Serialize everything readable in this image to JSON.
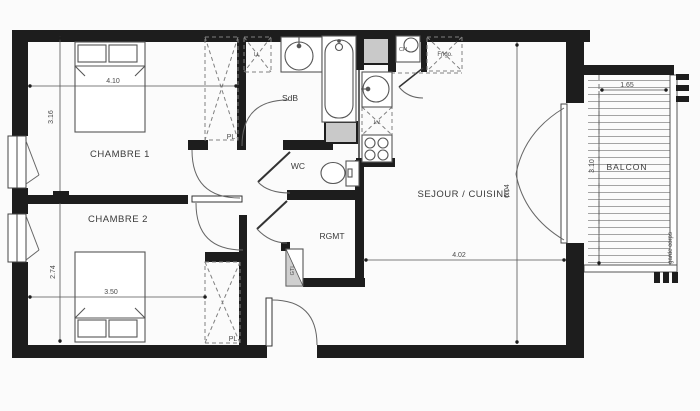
{
  "plan": {
    "title_hint": "apartment floor plan",
    "rooms": {
      "chambre1": "CHAMBRE 1",
      "chambre2": "CHAMBRE 2",
      "sdb": "SdB",
      "wc": "WC",
      "rgmt": "RGMT",
      "sejour": "SEJOUR / CUISINE",
      "balcon": "BALCON"
    },
    "closets": {
      "pl1": "PL",
      "pl2": "PL",
      "gtl": "GTL"
    },
    "appliances": {
      "ll": "LL",
      "lv": "LV",
      "ch": "CH",
      "frigo": "Frigo."
    },
    "dimensions": {
      "chambre1_width": "4.10",
      "chambre1_depth": "3.16",
      "chambre2_width": "3.50",
      "chambre2_depth": "2.74",
      "sejour_depth": "6.04",
      "sejour_width": "4.02",
      "balcon_width": "1.65",
      "balcon_depth": "3.10"
    },
    "annotations": {
      "garde_corps": "garde corps"
    },
    "colors": {
      "wall": "#1d1d1d",
      "shaft_fill": "#c9c9c9",
      "line": "#555555",
      "dashed": "#808080",
      "background": "#fbfbfb",
      "text": "#3a3a3a"
    }
  }
}
